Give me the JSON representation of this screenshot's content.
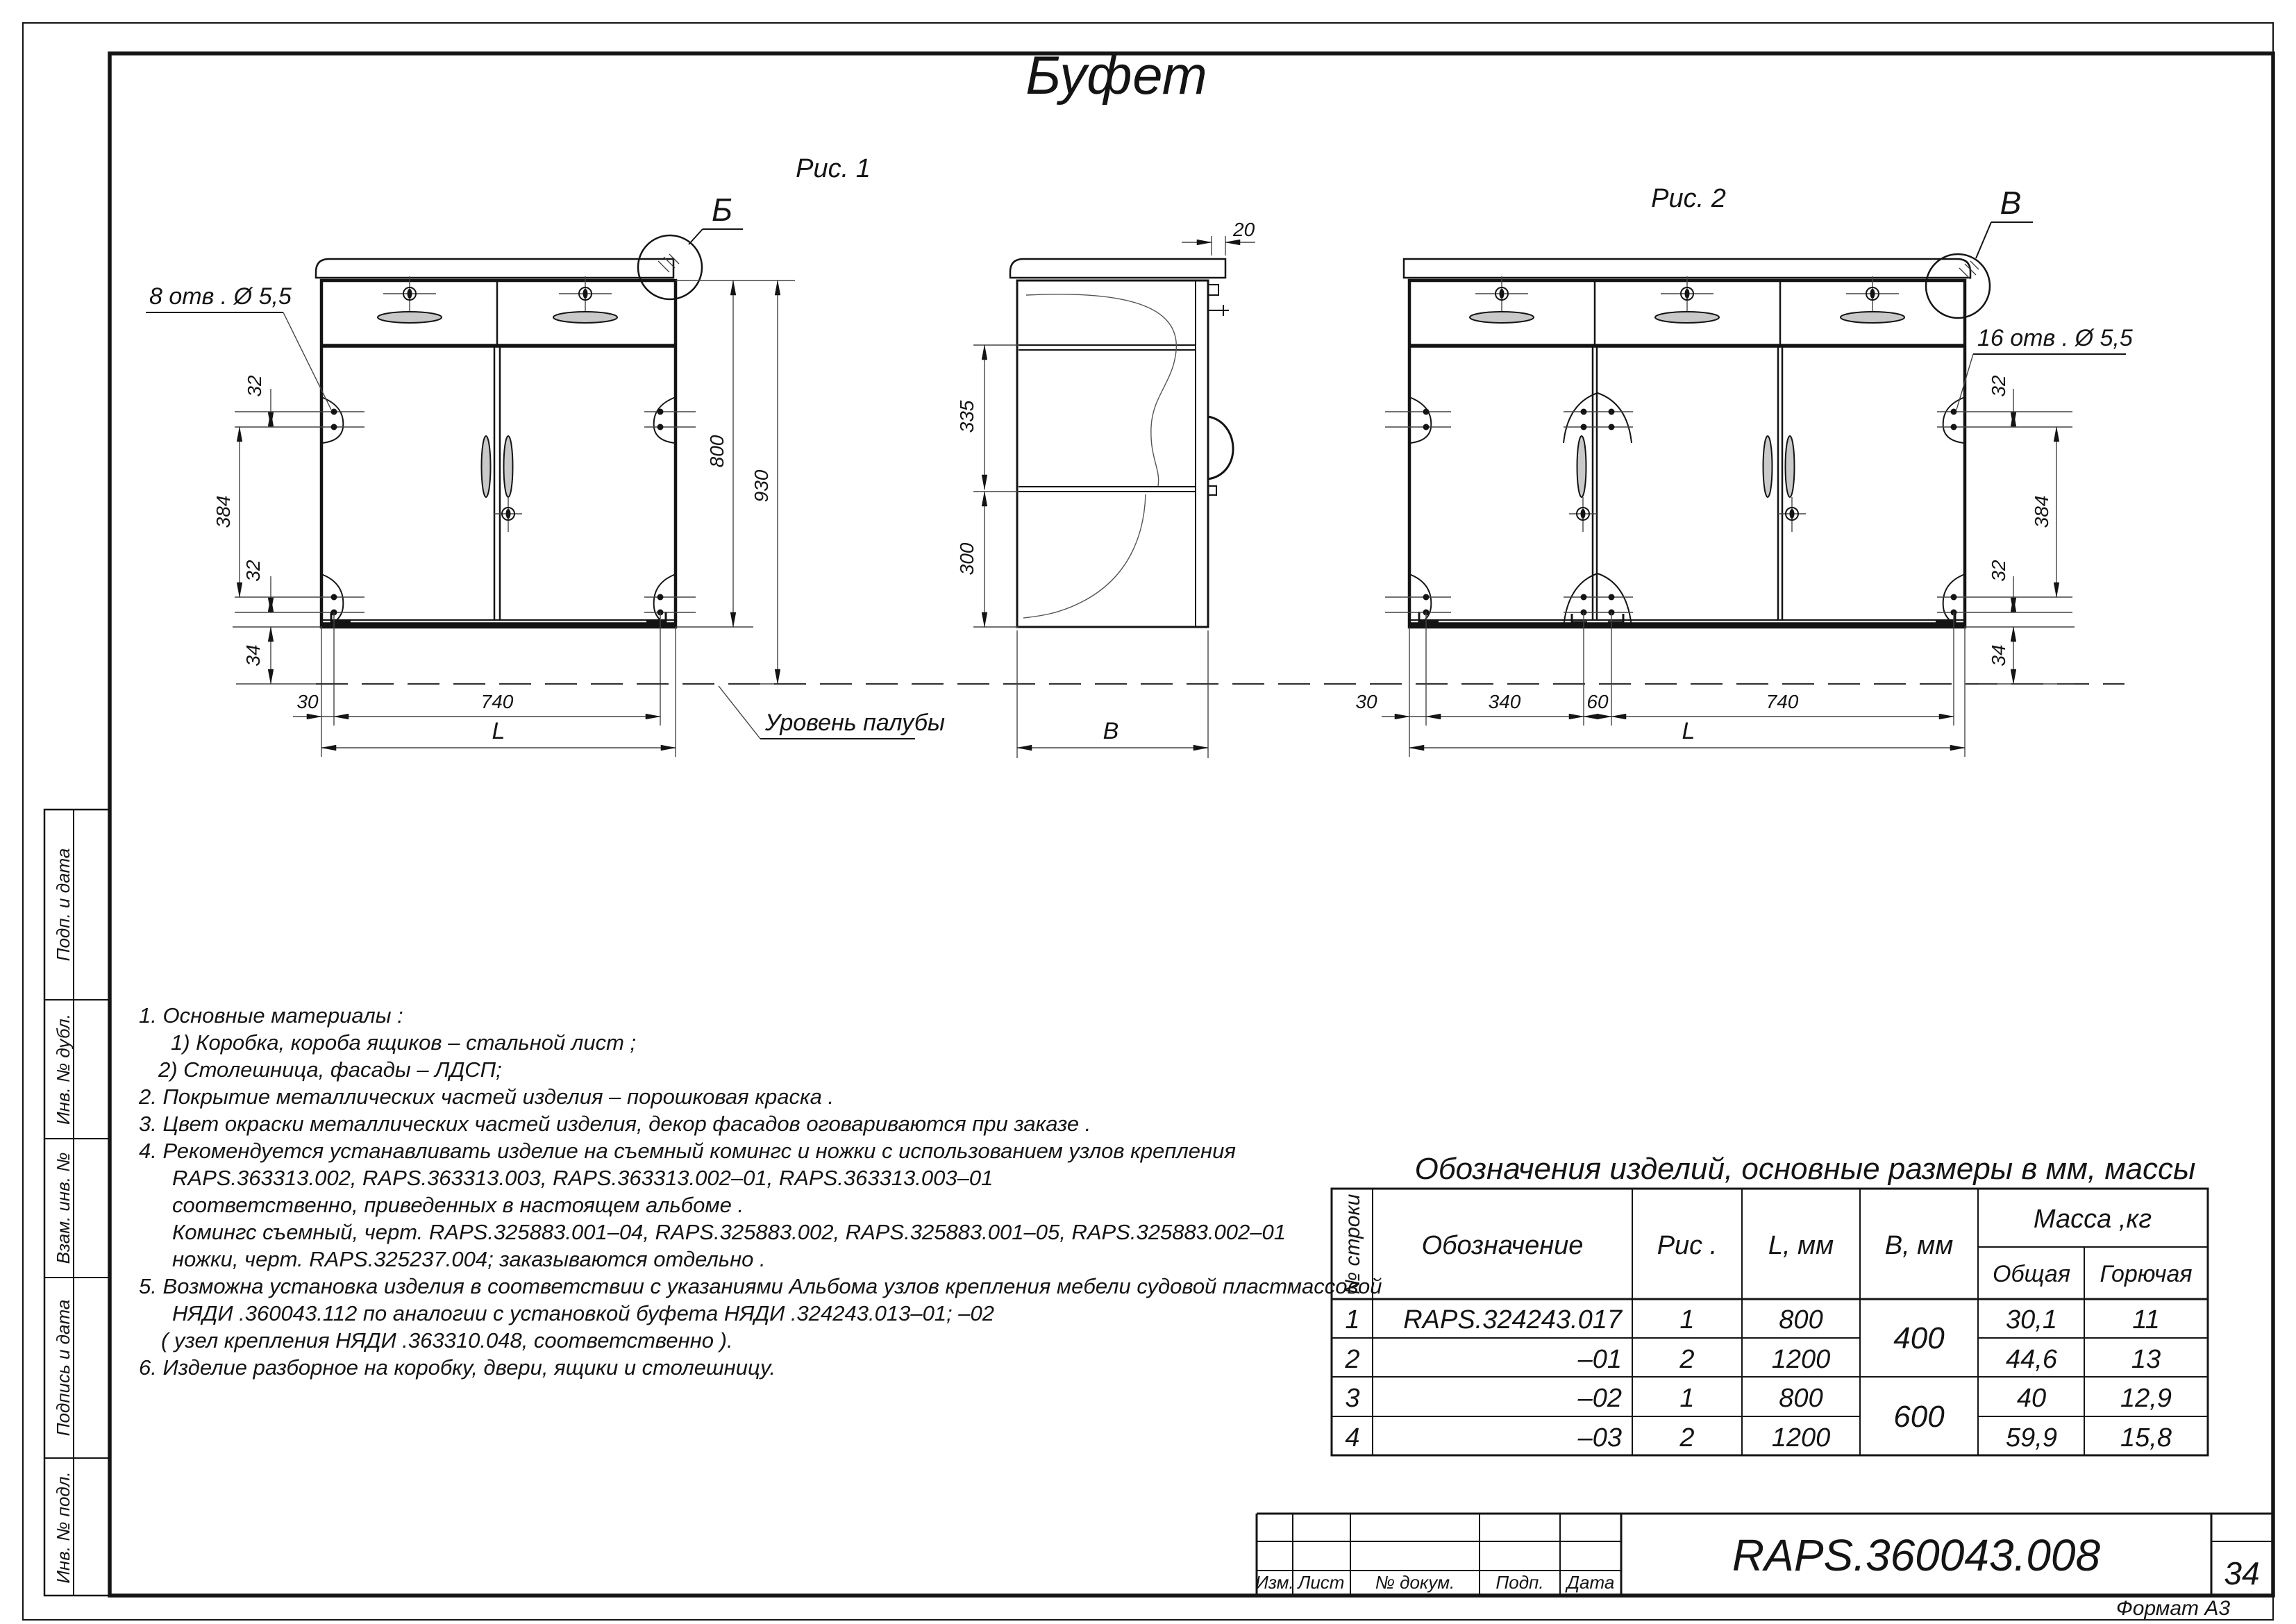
{
  "page": {
    "title": "Буфет",
    "doc_number": "RAPS.360043.008",
    "sheet_number": "34",
    "format_label": "Формат А3"
  },
  "figures": {
    "fig1": {
      "caption": "Рис. 1",
      "detail_label": "Б",
      "callout": "8  отв .  Ø 5,5",
      "deck_label": "Уровень палубы",
      "dims": {
        "d32a": "32",
        "d384": "384",
        "d32b": "32",
        "d34": "34",
        "d30": "30",
        "d740": "740",
        "dL": "L",
        "d800": "800",
        "d930": "930"
      }
    },
    "side": {
      "dims": {
        "d20": "20",
        "d335": "335",
        "d300": "300",
        "dB": "B"
      }
    },
    "fig2": {
      "caption": "Рис. 2",
      "detail_label": "В",
      "callout": "16  отв .  Ø 5,5",
      "dims": {
        "d32a": "32",
        "d384": "384",
        "d32b": "32",
        "d34": "34",
        "d30": "30",
        "d340": "340",
        "d60": "60",
        "d740": "740",
        "dL": "L"
      }
    }
  },
  "notes": {
    "lines": [
      "1.  Основные материалы :",
      "1)  Коробка, короба ящиков  –  стальной лист ;",
      "2)  Столешница, фасады  –  ЛДСП;",
      "2.  Покрытие металлических частей изделия  –  порошковая краска .",
      "3.  Цвет окраски металлических частей изделия, декор фасадов оговариваются при заказе .",
      "4.  Рекомендуется устанавливать изделие на съемный комингс и ножки с использованием узлов крепления",
      "RAPS.363313.002, RAPS.363313.003, RAPS.363313.002–01, RAPS.363313.003–01",
      "соответственно,  приведенных в настоящем альбоме .",
      "Комингс съемный,  черт.  RAPS.325883.001–04, RAPS.325883.002, RAPS.325883.001–05,  RAPS.325883.002–01",
      "ножки,  черт.  RAPS.325237.004;   заказываются отдельно .",
      "5.  Возможна установка изделия в соответствии с указаниями Альбома узлов крепления мебели судовой пластмассовой",
      "НЯДИ .360043.112  по аналогии с установкой  буфета НЯДИ .324243.013–01;  –02",
      "( узел крепления НЯДИ .363310.048,    соответственно ).",
      "6.  Изделие разборное на коробку, двери, ящики и столешницу."
    ]
  },
  "table": {
    "title": "Обозначения изделий,  основные размеры в мм,  массы",
    "headers": {
      "row_no": "№  строки",
      "designation": "Обозначение",
      "fig": "Рис .",
      "l": "L, мм",
      "b": "В, мм",
      "mass": "Масса ,кг",
      "mass_total": "Общая",
      "mass_flammable": "Горючая"
    },
    "rows": [
      {
        "no": "1",
        "designation": "RAPS.324243.017",
        "fig": "1",
        "l": "800",
        "mass_total": "30,1",
        "mass_flammable": "11"
      },
      {
        "no": "2",
        "designation": "–01",
        "fig": "2",
        "l": "1200",
        "mass_total": "44,6",
        "mass_flammable": "13"
      },
      {
        "no": "3",
        "designation": "–02",
        "fig": "1",
        "l": "800",
        "mass_total": "40",
        "mass_flammable": "12,9"
      },
      {
        "no": "4",
        "designation": "–03",
        "fig": "2",
        "l": "1200",
        "mass_total": "59,9",
        "mass_flammable": "15,8"
      }
    ],
    "b_groups": [
      {
        "value": "400"
      },
      {
        "value": "600"
      }
    ]
  },
  "title_block": {
    "labels": {
      "izm": "Изм.",
      "list": "Лист",
      "doc_no": "№  докум.",
      "podp": "Подп.",
      "data": "Дата"
    }
  },
  "sidebar": {
    "labels": [
      "Подп. и дата",
      "Инв. № дубл.",
      "Взам. инв. №",
      "Подпись и дата",
      "Инв. № подл."
    ]
  }
}
